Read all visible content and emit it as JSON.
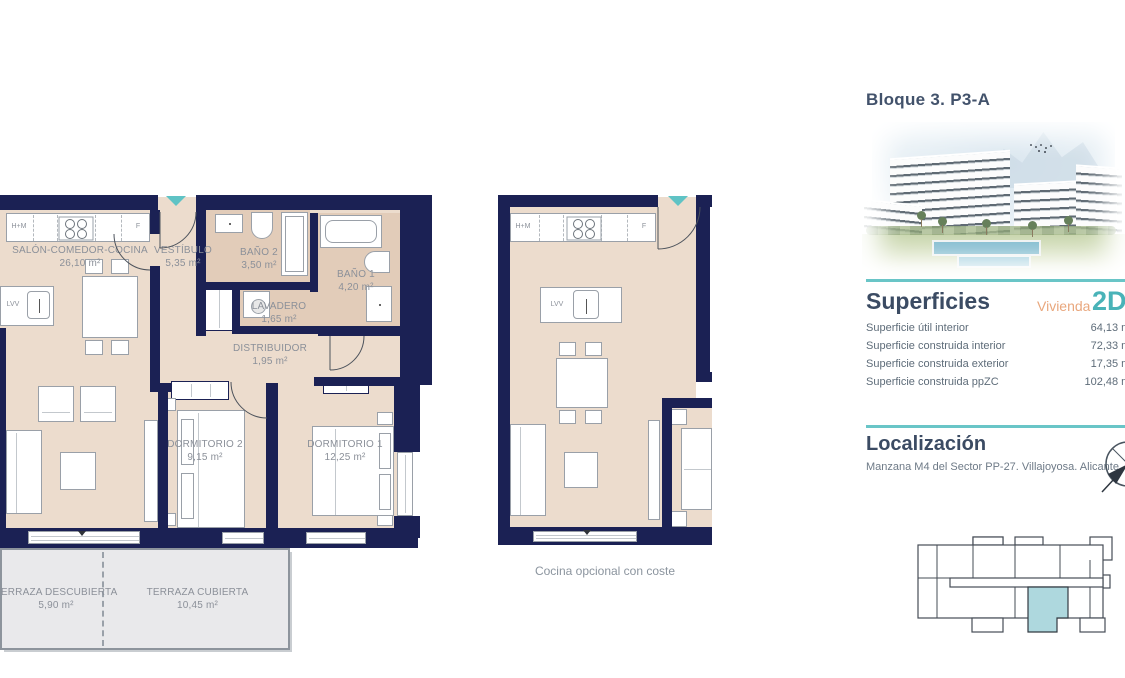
{
  "palette": {
    "wall_navy": "#1b2154",
    "room_beige": "#ecdccd",
    "wet_room_tan": "#e2ccb9",
    "terrace_gray": "#e9e9eb",
    "accent_teal": "#69c5c7",
    "heading_navy": "#3b4b63",
    "vivienda_orange": "#e9a77d",
    "type_teal": "#49b3b8",
    "highlighted_unit": "#aed8de"
  },
  "plan_main": {
    "kitchen": {
      "left": "H+M",
      "right": "F",
      "island": "LVV"
    },
    "rooms": [
      {
        "name": "SALÓN-COMEDOR-COCINA",
        "area": "26,10 m²"
      },
      {
        "name": "VESTÍBULO",
        "area": "5,35 m²"
      },
      {
        "name": "BAÑO 2",
        "area": "3,50 m²"
      },
      {
        "name": "BAÑO 1",
        "area": "4,20 m²"
      },
      {
        "name": "LAVADERO",
        "area": "1,65 m²"
      },
      {
        "name": "DISTRIBUIDOR",
        "area": "1,95 m²"
      },
      {
        "name": "DORMITORIO 2",
        "area": "9,15 m²"
      },
      {
        "name": "DORMITORIO 1",
        "area": "12,25 m²"
      },
      {
        "name": "TERRAZA DESCUBIERTA",
        "area": "5,90 m²"
      },
      {
        "name": "TERRAZA CUBIERTA",
        "area": "10,45 m²"
      }
    ]
  },
  "plan_optional": {
    "kitchen": {
      "left": "H+M",
      "right": "F",
      "island": "LVV"
    },
    "caption": "Cocina opcional con coste"
  },
  "sidebar": {
    "block_title": "Bloque 3. P3-A",
    "superficies": {
      "heading": "Superficies",
      "vivienda_label": "Vivienda",
      "vivienda_type": "2D",
      "rows": [
        {
          "label": "Superficie útil interior",
          "value": "64,13 m²"
        },
        {
          "label": "Superficie construida interior",
          "value": "72,33 m²"
        },
        {
          "label": "Superficie construida exterior",
          "value": "17,35 m²"
        },
        {
          "label": "Superficie construida ppZC",
          "value": "102,48 m²"
        }
      ]
    },
    "localizacion": {
      "heading": "Localización",
      "address": "Manzana M4 del Sector PP-27. Villajoyosa. Alicante"
    }
  }
}
